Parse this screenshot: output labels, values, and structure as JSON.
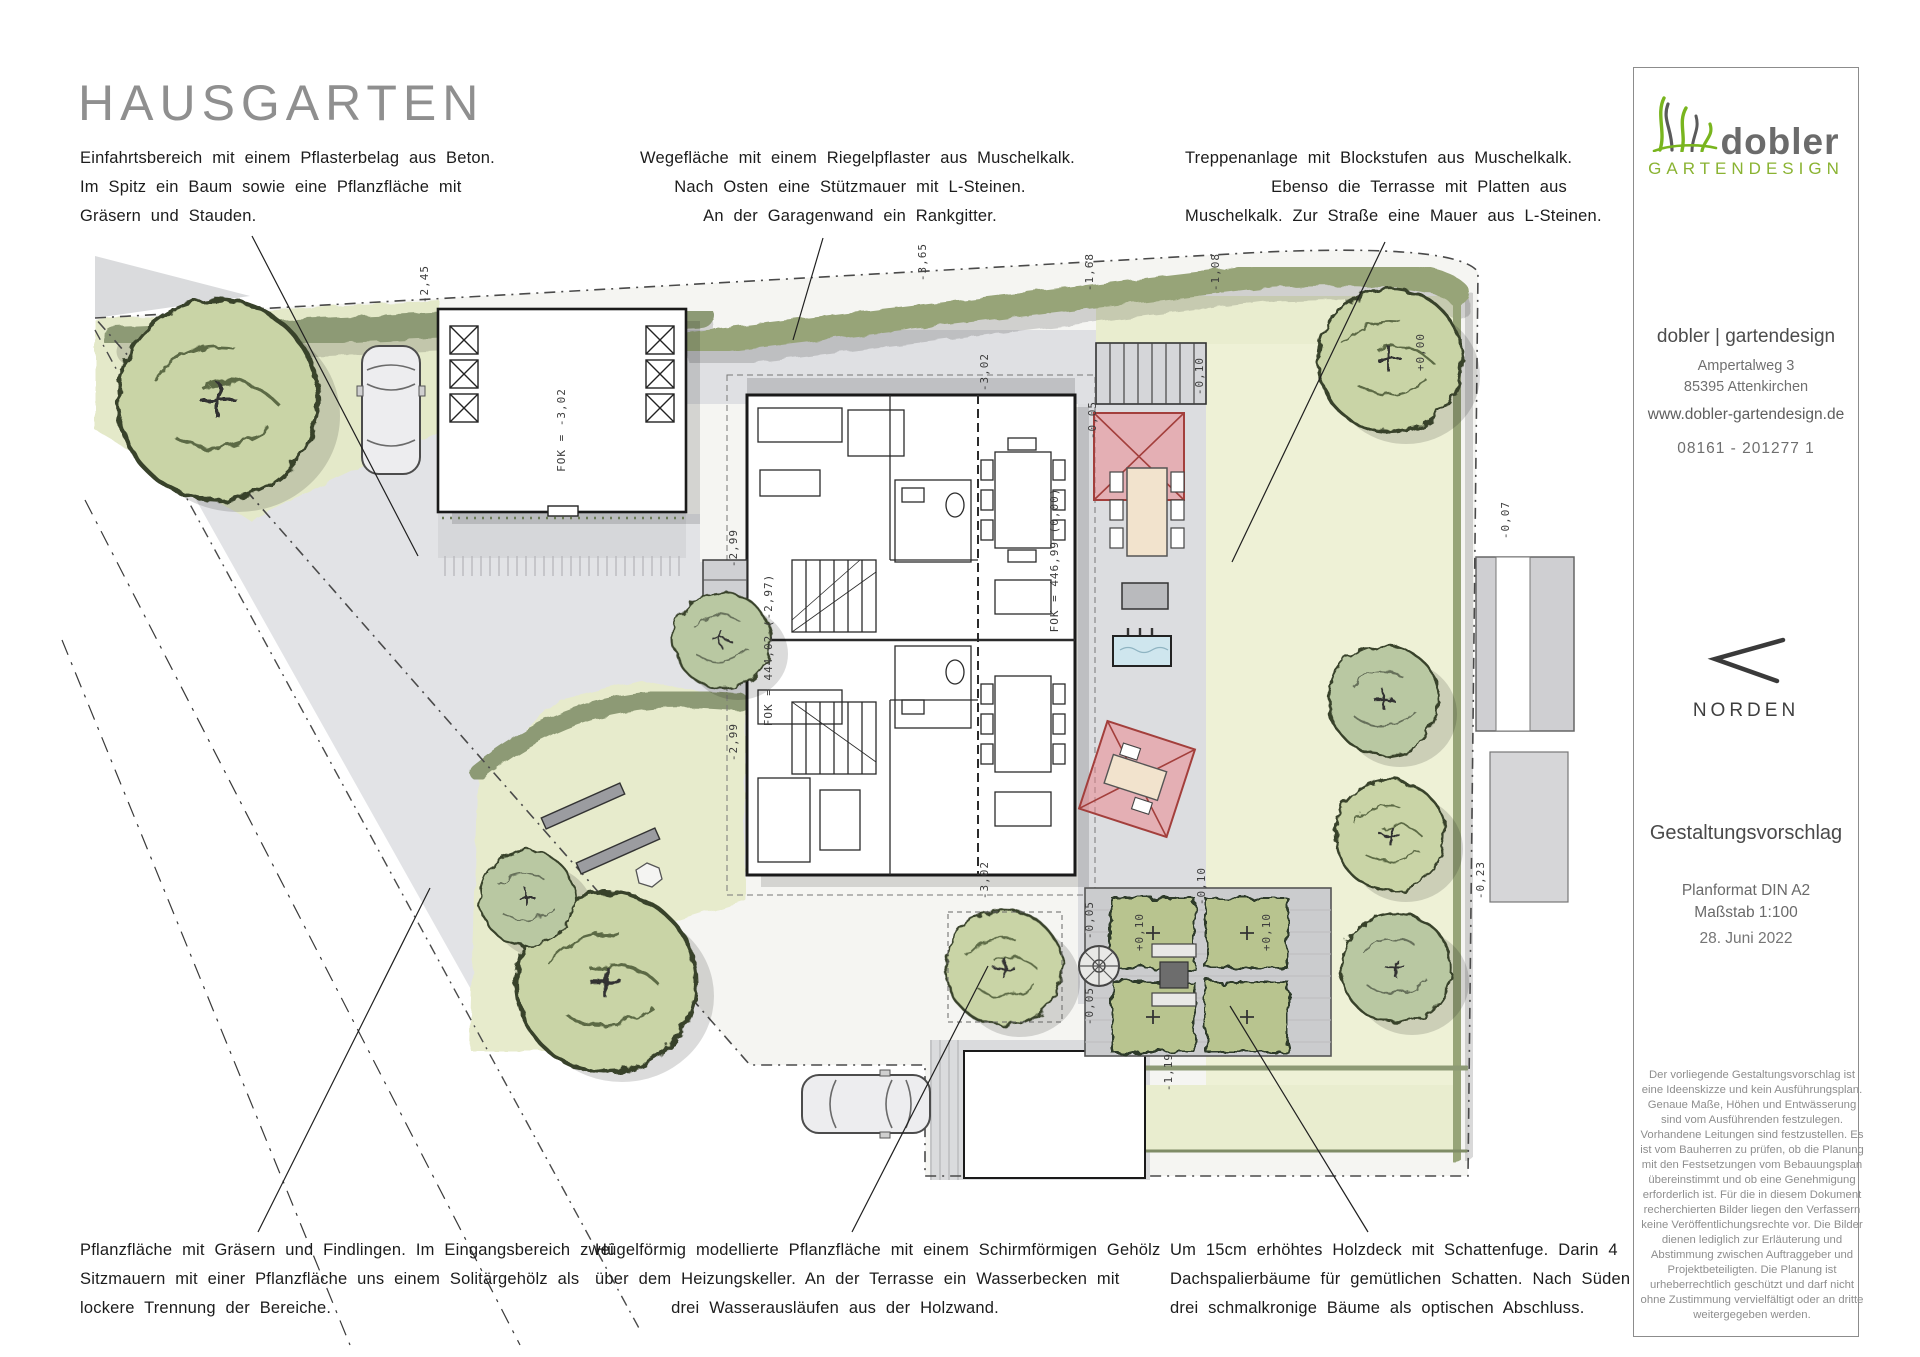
{
  "title": "HAUSGARTEN",
  "annotations": {
    "top_left": {
      "lines": [
        "Einfahrtsbereich mit einem Pflasterbelag aus Beton.",
        "Im Spitz ein Baum sowie eine Pflanzfläche mit",
        "Gräsern und Stauden."
      ]
    },
    "top_center": {
      "lines": [
        "Wegefläche mit einem Riegelpflaster aus Muschelkalk.",
        "Nach Osten eine Stützmauer mit L-Steinen.",
        "An der Garagenwand ein Rankgitter."
      ]
    },
    "top_right": {
      "lines": [
        "Treppenanlage mit Blockstufen aus Muschelkalk.",
        "Ebenso die Terrasse mit Platten aus",
        "Muschelkalk. Zur Straße eine Mauer aus L-Steinen."
      ]
    },
    "bottom_left": {
      "lines": [
        "Pflanzfläche mit Gräsern und Findlingen. Im Eingangsbereich zwei",
        "Sitzmauern mit einer Pflanzfläche uns einem Solitärgehölz als",
        "lockere Trennung der Bereiche."
      ]
    },
    "bottom_center": {
      "lines": [
        "Hügelförmig modellierte Pflanzfläche mit einem Schirmförmigen Gehölz",
        "über dem Heizungskeller. An der Terrasse ein Wasserbecken mit",
        "drei Wasserausläufen aus der Holzwand."
      ]
    },
    "bottom_right": {
      "lines": [
        "Um 15cm erhöhtes Holzdeck mit Schattenfuge. Darin 4",
        "Dachspalierbäume für gemütlichen Schatten. Nach Süden",
        "drei schmalkronige Bäume als optischen Abschluss."
      ]
    }
  },
  "sidebar": {
    "logo": {
      "name": "dobler",
      "subtitle": "GARTENDESIGN"
    },
    "contact": {
      "company": "dobler | gartendesign",
      "street": "Ampertalweg 3",
      "city": "85395 Attenkirchen",
      "website": "www.dobler-gartendesign.de",
      "phone": "08161 - 201277 1"
    },
    "north_label": "NORDEN",
    "plan_type": "Gestaltungsvorschlag",
    "format": "Planformat DIN A2",
    "scale": "Maßstab 1:100",
    "date": "28. Juni 2022",
    "disclaimer": "Der vorliegende Gestaltungsvorschlag ist eine Ideenskizze und kein Ausführungsplan. Genaue Maße, Höhen und Entwässerung sind vom Ausführenden festzulegen. Vorhandene Leitungen sind festzustellen. Es ist vom Bauherren zu prüfen, ob die Planung mit den Festsetzungen vom Bebauungsplan übereinstimmt und ob eine Genehmigung erforderlich ist. Für die in diesem Dokument recherchierten Bilder liegen den Verfassern keine Veröffentlichungsrechte vor. Die Bilder dienen lediglich zur Erläuterung und Abstimmung zwischen Auftraggeber und Projektbeteiligten. Die Planung ist urheberrechtlich geschützt und darf nicht ohne Zustimmung vervielfältigt oder an dritte weitergegeben werden."
  },
  "plan": {
    "colors": {
      "lawn": "#eef1d6",
      "hedge": "#97a478",
      "paving": "#dfe0e3",
      "pavilion": "#ecb9bc",
      "water": "#cfe6ee",
      "tree": "#c9d4a6"
    },
    "labels": [
      {
        "text": "-2,45",
        "x": 428,
        "y": 284,
        "rot": -90
      },
      {
        "text": "-3,65",
        "x": 926,
        "y": 262,
        "rot": -90
      },
      {
        "text": "-3,02",
        "x": 988,
        "y": 372,
        "rot": -90
      },
      {
        "text": "-1,68",
        "x": 1093,
        "y": 272,
        "rot": -90
      },
      {
        "text": "-1,08",
        "x": 1219,
        "y": 272,
        "rot": -90
      },
      {
        "text": "+0,00",
        "x": 1424,
        "y": 352,
        "rot": -90
      },
      {
        "text": "-0,07",
        "x": 1509,
        "y": 520,
        "rot": -90
      },
      {
        "text": "-2,99",
        "x": 737,
        "y": 548,
        "rot": -90
      },
      {
        "text": "-2,99",
        "x": 737,
        "y": 742,
        "rot": -90
      },
      {
        "text": "-0,05",
        "x": 1096,
        "y": 420,
        "rot": -90
      },
      {
        "text": "-0,10",
        "x": 1203,
        "y": 376,
        "rot": -90
      },
      {
        "text": "-0,05",
        "x": 1093,
        "y": 920,
        "rot": -90
      },
      {
        "text": "+0,10",
        "x": 1143,
        "y": 932,
        "rot": -90
      },
      {
        "text": "+0,10",
        "x": 1270,
        "y": 932,
        "rot": -90
      },
      {
        "text": "-0,10",
        "x": 1205,
        "y": 886,
        "rot": -90
      },
      {
        "text": "-0,05",
        "x": 1093,
        "y": 1006,
        "rot": -90
      },
      {
        "text": "-0,23",
        "x": 1484,
        "y": 880,
        "rot": -90
      },
      {
        "text": "-1,19",
        "x": 1172,
        "y": 1072,
        "rot": -90
      },
      {
        "text": "-3,02",
        "x": 988,
        "y": 880,
        "rot": -90
      },
      {
        "text": "FOK = -3,02",
        "x": 565,
        "y": 430,
        "rot": -90
      },
      {
        "text": "FOK = 444,02 (-2,97)",
        "x": 772,
        "y": 650,
        "rot": -90
      },
      {
        "text": "FOK = 446,99 (0,00)",
        "x": 1058,
        "y": 560,
        "rot": -90
      }
    ]
  }
}
